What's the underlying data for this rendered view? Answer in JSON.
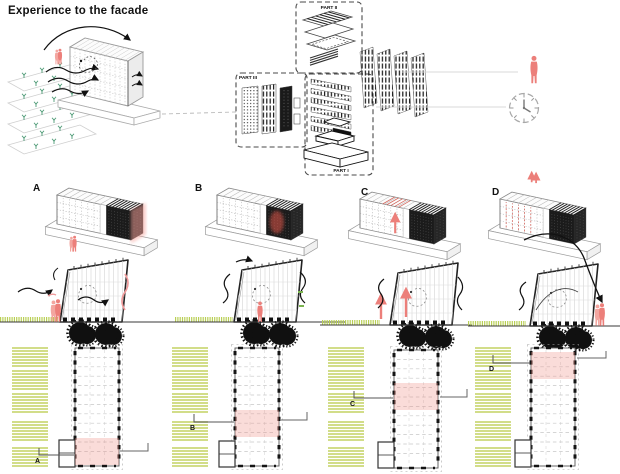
{
  "title": "Experience to the facade",
  "exploded": {
    "part_i": "PART I",
    "part_ii": "PART II",
    "part_iii": "PART III"
  },
  "legend": {
    "icons": [
      "person-icon",
      "clock-icon"
    ]
  },
  "variants": [
    {
      "label": "A",
      "plan_zone": "bottom"
    },
    {
      "label": "B",
      "plan_zone": "lower-middle"
    },
    {
      "label": "C",
      "plan_zone": "upper-middle"
    },
    {
      "label": "D",
      "plan_zone": "top"
    }
  ],
  "colors": {
    "accent_pink": "#ec7f7a",
    "zone_pink": "rgba(240,140,128,0.30)",
    "field_green": "#ccd878",
    "grass_green": "#b9cf55",
    "plant_green": "#4f9b77",
    "ink": "#1a1a1a",
    "line_gray": "#9b9b9b"
  }
}
